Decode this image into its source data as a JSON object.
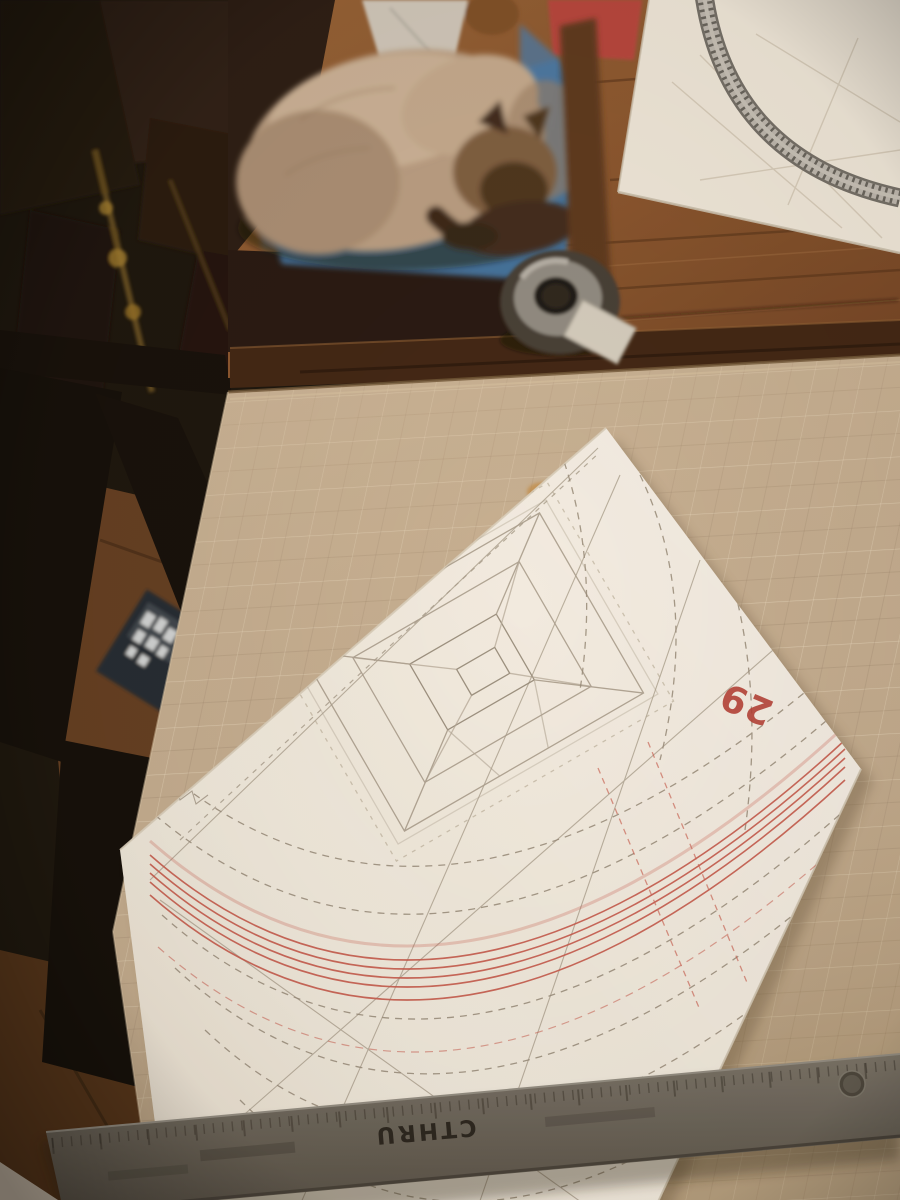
{
  "scene": {
    "pattern_sheet": {
      "radius_label": "29"
    },
    "ruler": {
      "brand": "CTHRU"
    },
    "colors": {
      "background_dark": "#14100b",
      "wood_table": "#8a5733",
      "wood_apron": "#3a2112",
      "wood_floor": "#4f3018",
      "cutting_mat": "#c2ad93",
      "mat_grid_light": "#f2e7d0",
      "paper_white": "#f0ebe2",
      "pencil_line": "#a89f91",
      "dashed_line": "#93897b",
      "red_line": "#c4574c",
      "red_label": "#b03a33",
      "ruler_gray": "#66625c",
      "cushion_blue": "#3e6f9f",
      "cat_fur": "#b89e85",
      "cat_points_dark": "#46301f",
      "track_gray": "#bab7b1",
      "pink_cushion": "#b5433c",
      "brass": "#a5812f"
    }
  }
}
